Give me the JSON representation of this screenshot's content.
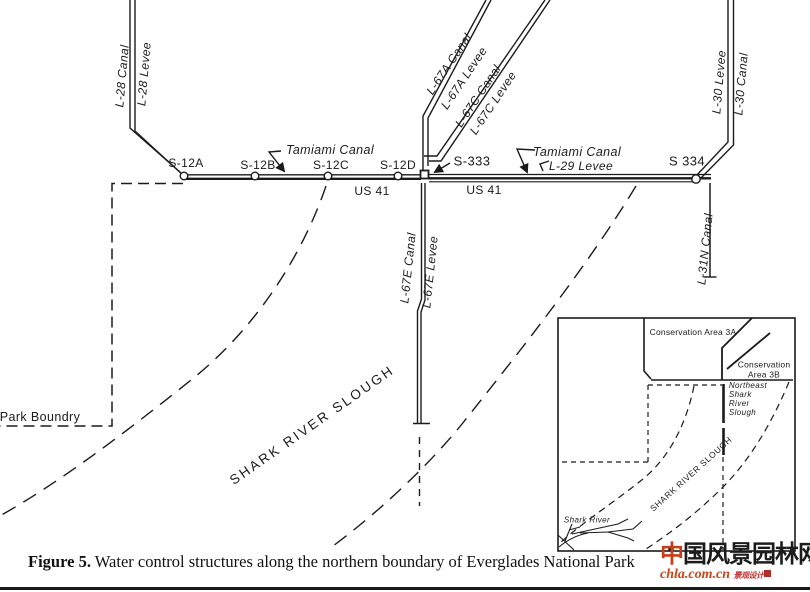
{
  "colors": {
    "ink": "#1b1b1b",
    "accent_red": "#c4401a",
    "url_red": "#cc4418"
  },
  "map": {
    "canal_labels": {
      "l28_canal": "L-28 Canal",
      "l28_levee": "L-28 Levee",
      "l67a_canal": "L-67A Canal",
      "l67a_levee": "L-67A Levee",
      "l67c_canal": "L-67C Canal",
      "l67c_levee": "L-67C Levee",
      "l30_levee": "L-30 Levee",
      "l30_canal": "L-30 Canal",
      "l67e_canal": "L-67E Canal",
      "l67e_levee": "L-67E Levee",
      "l31n_canal": "L-31N Canal",
      "l29_levee": "L-29 Levee",
      "tamiami_west": "Tamiami Canal",
      "tamiami_east": "Tamiami Canal",
      "us41_west": "US 41",
      "us41_east": "US 41"
    },
    "structures": [
      {
        "label": "S-12A"
      },
      {
        "label": "S-12B"
      },
      {
        "label": "S-12C"
      },
      {
        "label": "S-12D"
      },
      {
        "label": "S-333"
      },
      {
        "label": "S 334"
      }
    ],
    "park_boundary": "Park Boundry",
    "slough": "SHARK RIVER SLOUGH"
  },
  "inset": {
    "area_3a": "Conservation Area 3A",
    "area_3b": "Conservation\nArea 3B",
    "ne_slough": "Northeast\nShark\nRiver\nSlough",
    "slough": "SHARK RIVER SLOUGH",
    "shark_river": "Shark River"
  },
  "caption": {
    "label": "Figure 5.",
    "text": "Water control structures along the northern boundary of Everglades National Park"
  },
  "watermark": {
    "cn_first": "中",
    "cn_rest": "国风景园林网",
    "url": "chla.com.cn",
    "tagline": "景观设计"
  }
}
